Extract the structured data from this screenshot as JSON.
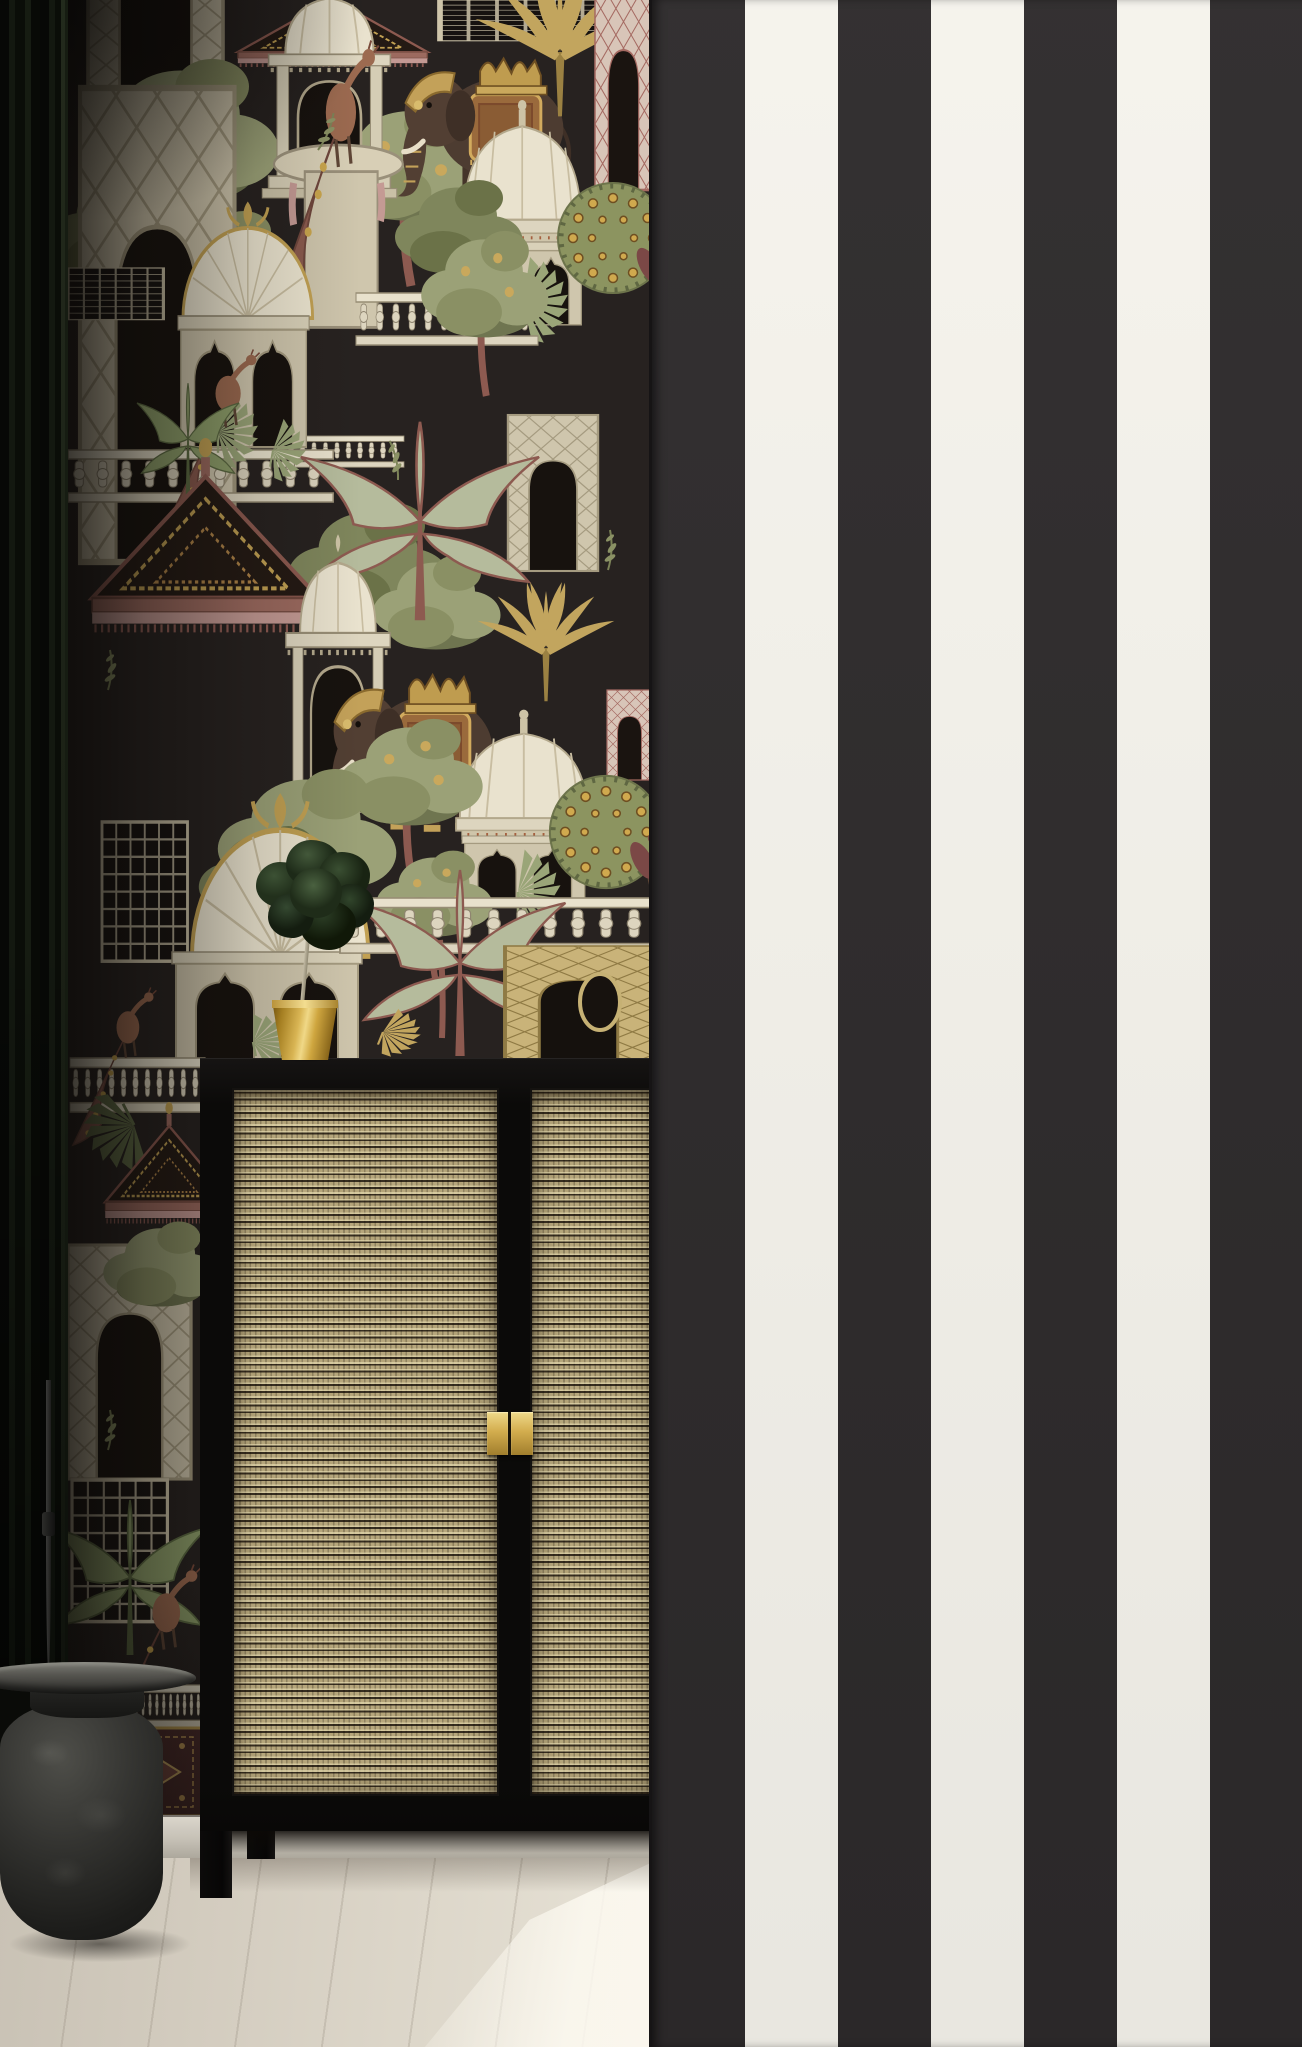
{
  "meta": {
    "type": "interior photograph",
    "caption": "Interior scene: Indo-chinoiserie palace-garden mural wallpaper on a dark wall, a bold black-and-white striped feature wall in the foreground, a black cane-front cabinet with brass handles, a topiary in a brass pot, a black stone side table, a dark curtain and pale wood flooring."
  },
  "left_wall": {
    "name": "mural wallpaper wall",
    "style": "Indian palace garden mural on near-black ground",
    "background_hex": "#272220",
    "motifs": [
      "domed pavilions",
      "chhatris",
      "caparisoned elephants",
      "peacocks",
      "gold palms",
      "banana plants",
      "lattice trellis arches",
      "balustrades",
      "scalloped carpet canopy",
      "ornamental carpet band"
    ],
    "motif_colors": {
      "cream": "#e9e2ce",
      "sage": "#9ba177",
      "olive": "#6f7550",
      "gold": "#c2a55e",
      "maroon": "#8a5a4e",
      "rose": "#c49a94",
      "elephant_brown": "#4d3c31"
    }
  },
  "right_wall": {
    "name": "striped feature wall",
    "stripe_dark_hex": "#2d2a2b",
    "stripe_light_hex": "#f5f3ec",
    "stripe_width_px": 93,
    "first_stripe": "dark"
  },
  "furniture": {
    "cabinet": {
      "name": "black cane cabinet",
      "frame_hex": "#0b0a09",
      "cane_hex": "#bfb084",
      "doors": 2,
      "handle_count": 2,
      "handle_hex": "#d3ad4e"
    },
    "side_table": {
      "name": "black stone side table",
      "body_hex": "#1d1d1b",
      "top_hex": "#565550"
    }
  },
  "decor": {
    "plant": {
      "name": "topiary in brass pot",
      "foliage_hex": "#2c3e26",
      "pot_hex": "#d9b554"
    },
    "curtain": {
      "name": "dark green-black curtain",
      "hex": "#0d110b"
    }
  },
  "floor": {
    "name": "pale wood floor",
    "hex": "#d4cdc0",
    "baseboard_hex": "#c4bfb4",
    "sunlight_patch": true
  }
}
